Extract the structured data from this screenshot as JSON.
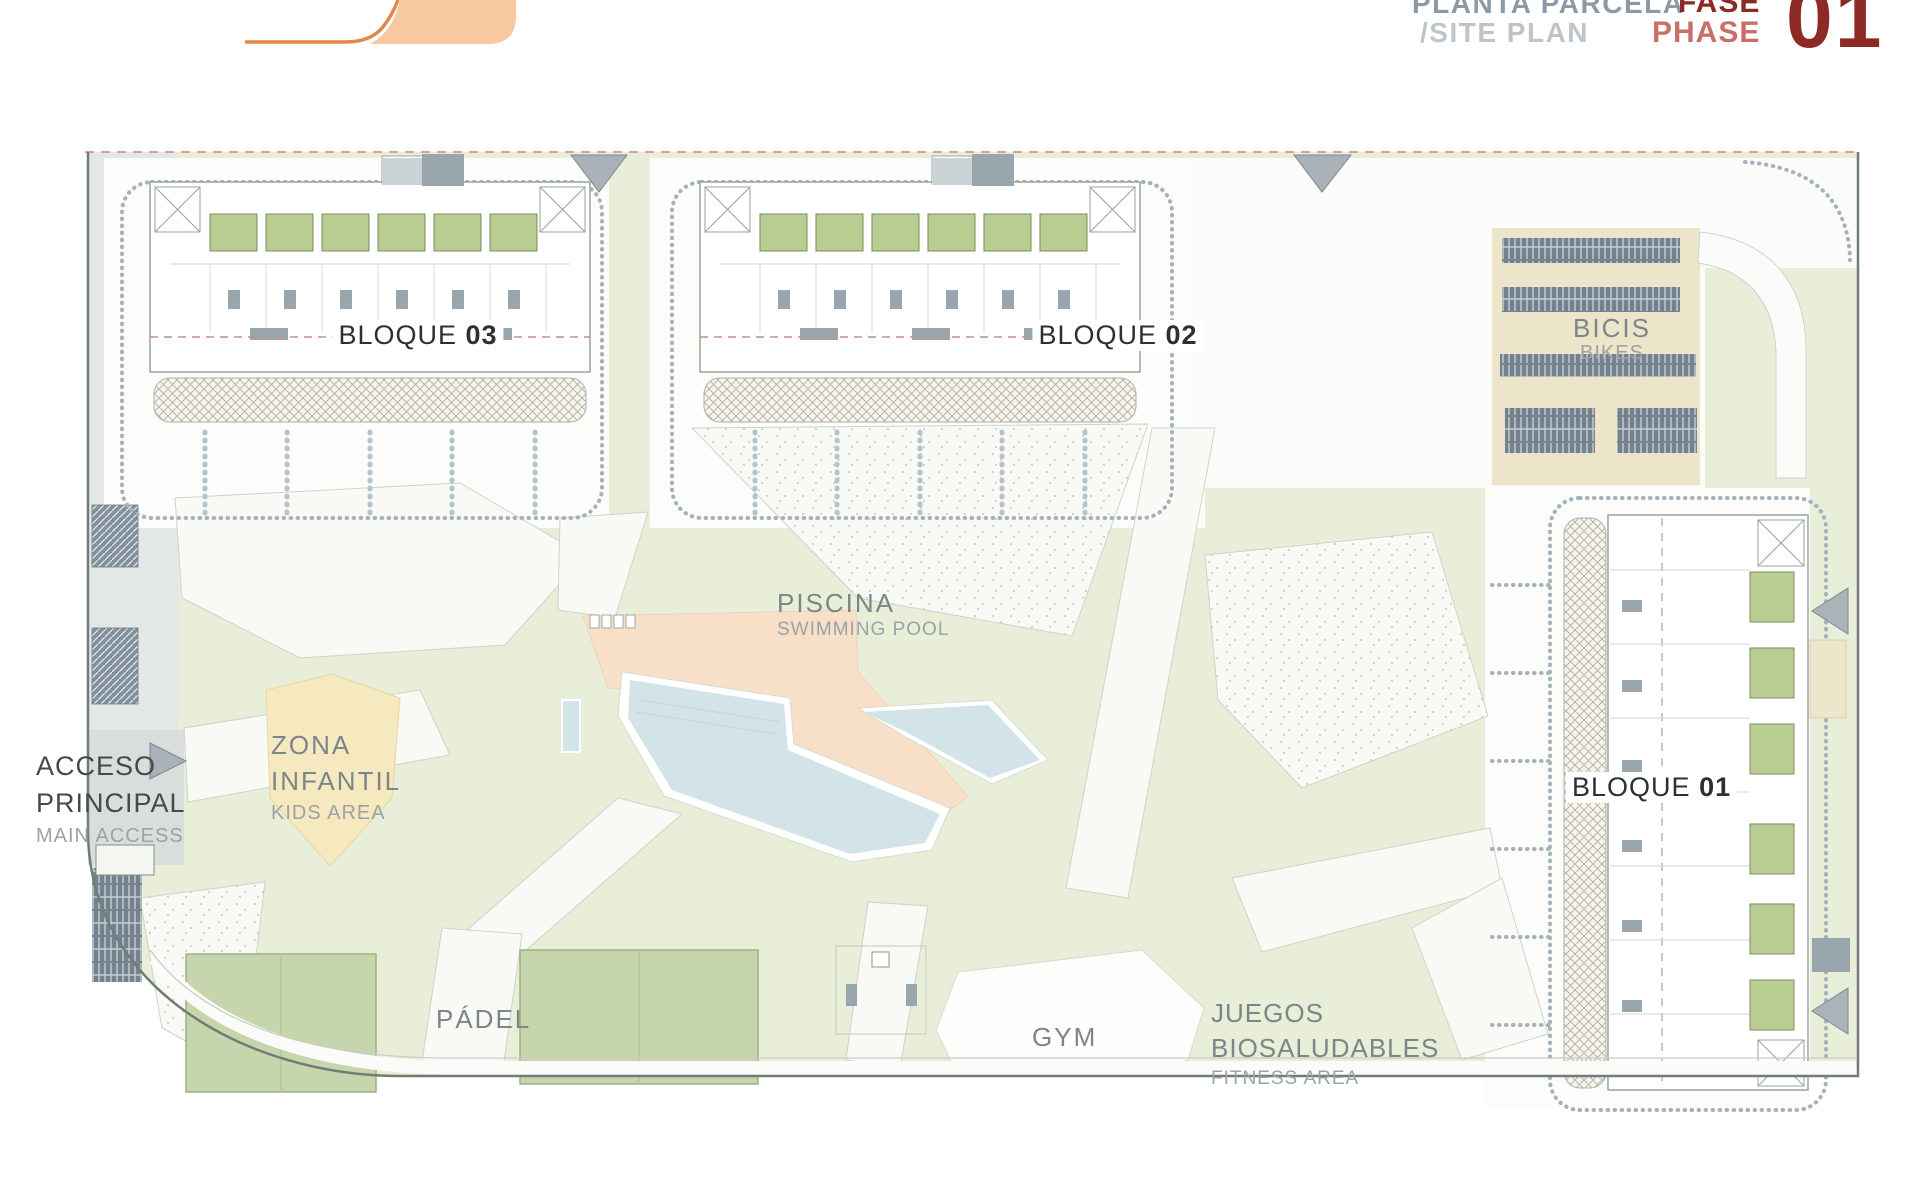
{
  "header": {
    "logo": "brand-logo",
    "title_es": "PLANTA PARCELA",
    "title_en": "/SITE PLAN",
    "phase_label_es": "FASE",
    "phase_label_en": "PHASE",
    "phase_number": "01"
  },
  "site": {
    "blocks": [
      {
        "id": "bloque-03",
        "label": "BLOQUE",
        "number": "03"
      },
      {
        "id": "bloque-02",
        "label": "BLOQUE",
        "number": "02"
      },
      {
        "id": "bloque-01",
        "label": "BLOQUE",
        "number": "01"
      }
    ],
    "areas": {
      "bikes": {
        "es": "BICIS",
        "en": "BIKES"
      },
      "pool": {
        "es": "PISCINA",
        "en": "SWIMMING POOL"
      },
      "kids": {
        "es_line1": "ZONA",
        "es_line2": "INFANTIL",
        "en": "KIDS AREA"
      },
      "access": {
        "es_line1": "ACCESO",
        "es_line2": "PRINCIPAL",
        "en": "MAIN ACCESS"
      },
      "padel": {
        "es": "PÁDEL"
      },
      "gym": {
        "es": "GYM"
      },
      "fitness": {
        "es_line1": "JUEGOS",
        "es_line2": "BIOSALUDABLES",
        "en": "FITNESS AREA"
      }
    }
  },
  "colors": {
    "accent_dark_red": "#8e2a26",
    "accent_light_red": "#c96f68",
    "logo_peach": "#f8c9a0",
    "logo_orange": "#e08948",
    "ground_green": "#e9eed9",
    "patch_green": "#b9cd92",
    "pool_blue": "#d3e4e8",
    "deck_peach": "#f8dfc8",
    "kids_yellow": "#f6e9c0",
    "bike_beige": "#ece5c9",
    "rack_slate": "#74828f",
    "boundary_dash": "#d8a396"
  }
}
